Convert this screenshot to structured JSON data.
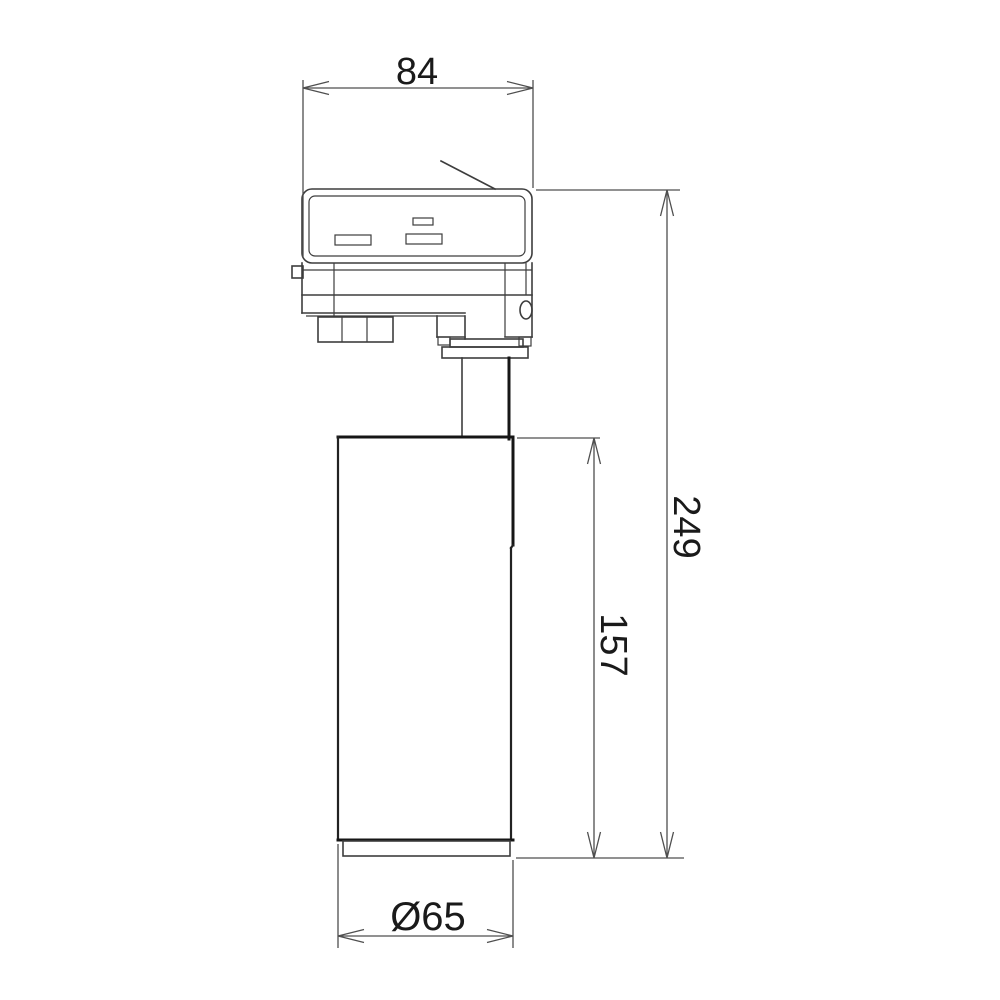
{
  "colors": {
    "bg": "#ffffff",
    "line": "#3d3d3d",
    "bold": "#161616",
    "dim": "#4f4f4f",
    "text": "#1a1a1a"
  },
  "dimensions": {
    "top_width": {
      "label": "84"
    },
    "overall_height": {
      "label": "249"
    },
    "body_height": {
      "label": "157"
    },
    "diameter": {
      "label": "Ø65"
    }
  }
}
